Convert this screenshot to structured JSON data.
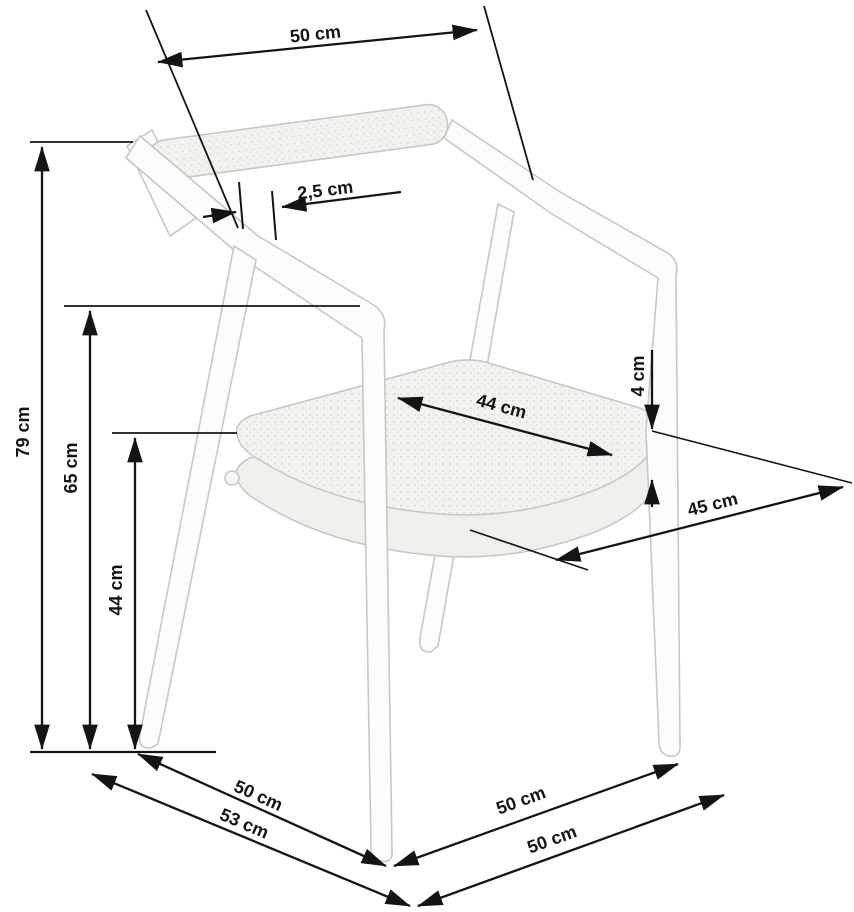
{
  "page": {
    "type": "furniture-dimension-diagram",
    "product": "armchair line drawing with measurements",
    "unit": "cm",
    "background": "#ffffff"
  },
  "colors": {
    "dimension_line": "#141414",
    "chair_outline": "#c7c7c7",
    "chair_fill": "#fcfcfc",
    "cushion_fill": "#f3f2ef"
  },
  "dims": {
    "backrest_width": {
      "id": "backrest-width",
      "label": "50 cm"
    },
    "frame_thickness": {
      "id": "frame-thickness",
      "label": "2,5 cm"
    },
    "total_height": {
      "id": "total-height",
      "label": "79 cm"
    },
    "armrest_height": {
      "id": "armrest-height",
      "label": "65 cm"
    },
    "seat_height": {
      "id": "seat-height",
      "label": "44 cm"
    },
    "seat_width": {
      "id": "seat-width",
      "label": "44 cm"
    },
    "cushion_thickness": {
      "id": "cushion-thickness",
      "label": "4 cm"
    },
    "seat_depth": {
      "id": "seat-depth",
      "label": "45 cm"
    },
    "side_depth_inner": {
      "id": "side-depth-inner",
      "label": "50 cm"
    },
    "side_depth_total": {
      "id": "side-depth-total",
      "label": "53 cm"
    },
    "front_width_inner": {
      "id": "front-width-inner",
      "label": "50 cm"
    },
    "front_width_total": {
      "id": "front-width-total",
      "label": "50 cm"
    }
  }
}
